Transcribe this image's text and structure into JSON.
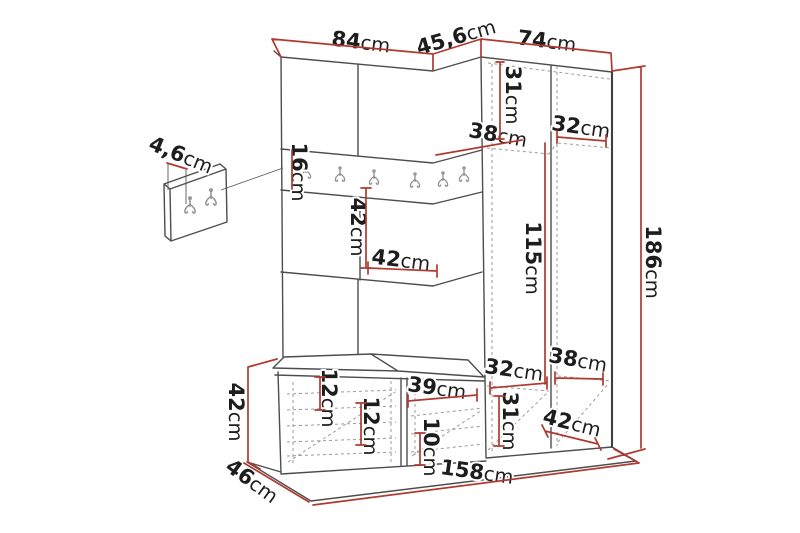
{
  "diagram": {
    "kind": "furniture-dimension-drawing",
    "subject": "hallway storage set: coat rack panel with hooks, corner wardrobe column and shoe bench",
    "units": "cm",
    "colors": {
      "dimension_line": "#ae3a30",
      "outline": "#4d4d4d",
      "hidden_line": "#9b9b9b",
      "label_text": "#1d1d1d",
      "background": "#ffffff"
    },
    "icons": {
      "coat_hook": "double-prong-wall-hook"
    },
    "hook_rail": {
      "hook_count": 6
    },
    "detail_panel": {
      "hook_count": 2
    },
    "dims": {
      "top_left_width": {
        "value": "84",
        "unit": "cm"
      },
      "corner_width": {
        "value": "45,6",
        "unit": "cm"
      },
      "top_right_width": {
        "value": "74",
        "unit": "cm"
      },
      "panel_thickness": {
        "value": "4,6",
        "unit": "cm"
      },
      "rail_height": {
        "value": "16",
        "unit": "cm"
      },
      "corner_top_height": {
        "value": "31",
        "unit": "cm"
      },
      "corner_top_depth": {
        "value": "38",
        "unit": "cm"
      },
      "right_top_width": {
        "value": "32",
        "unit": "cm"
      },
      "niche_height": {
        "value": "42",
        "unit": "cm"
      },
      "niche_width": {
        "value": "42",
        "unit": "cm"
      },
      "column_mid_height": {
        "value": "115",
        "unit": "cm"
      },
      "total_height": {
        "value": "186",
        "unit": "cm"
      },
      "corner_bottom_width": {
        "value": "32",
        "unit": "cm"
      },
      "right_bottom_shelf": {
        "value": "38",
        "unit": "cm"
      },
      "corner_bottom_height": {
        "value": "31",
        "unit": "cm"
      },
      "right_bottom_depth": {
        "value": "42",
        "unit": "cm"
      },
      "bench_gap_top": {
        "value": "12",
        "unit": "cm"
      },
      "bench_gap_mid": {
        "value": "12",
        "unit": "cm"
      },
      "bench_door_width": {
        "value": "39",
        "unit": "cm"
      },
      "bench_gap_bottom": {
        "value": "10",
        "unit": "cm"
      },
      "bench_height": {
        "value": "42",
        "unit": "cm"
      },
      "bench_depth": {
        "value": "46",
        "unit": "cm"
      },
      "total_width": {
        "value": "158",
        "unit": "cm"
      }
    }
  }
}
